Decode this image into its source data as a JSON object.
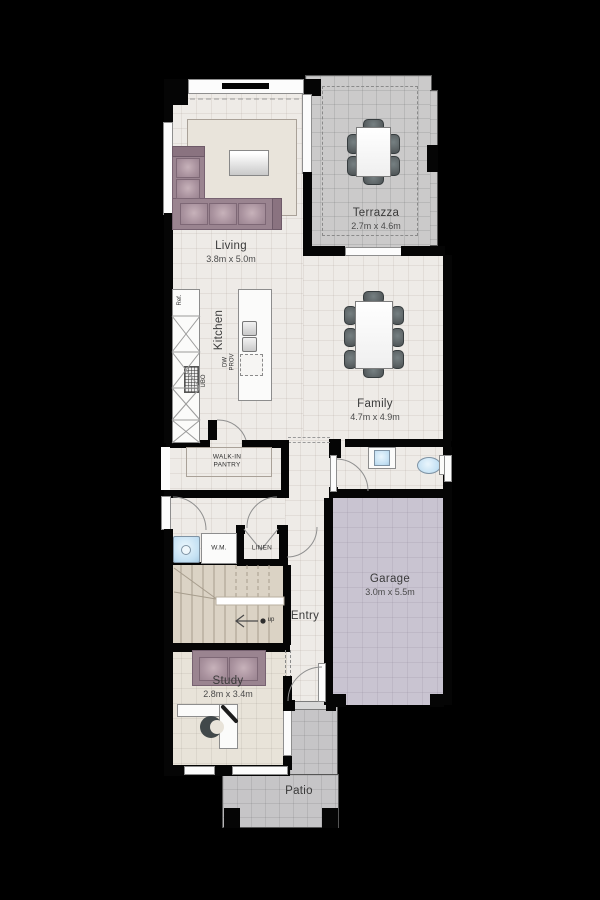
{
  "plan_title": "House floor plan",
  "colors": {
    "wall": "#050505",
    "interior_floor": "#EEEBE7",
    "stairs_floor": "#DBD3C5",
    "study_floor": "#E8E3D9",
    "terrazza_floor": "#CBCACA",
    "patio_floor": "#C6C5C7",
    "garage_floor": "#C9C4D1",
    "sofa": "#9A8490",
    "chair": "#5E6567",
    "fixture_blue": "#C3E0F3"
  },
  "rooms": {
    "living": {
      "name": "Living",
      "dims": "3.8m x 5.0m"
    },
    "terrazza": {
      "name": "Terrazza",
      "dims": "2.7m x 4.6m"
    },
    "kitchen": {
      "name": "Kitchen"
    },
    "family": {
      "name": "Family",
      "dims": "4.7m x 4.9m"
    },
    "pantry": {
      "line1": "WALK-IN",
      "line2": "PANTRY"
    },
    "laundry": {
      "wm": "W.M."
    },
    "linen": {
      "name": "LINEN"
    },
    "entry": {
      "name": "Entry"
    },
    "garage": {
      "name": "Garage",
      "dims": "3.0m x 5.5m"
    },
    "study": {
      "name": "Study",
      "dims": "2.8m x 3.4m"
    },
    "patio": {
      "name": "Patio"
    }
  },
  "annotations": {
    "fridge": "Ref.",
    "oven": "UBO",
    "dishwasher": "DW\nPROV",
    "stairs_direction": "up"
  }
}
